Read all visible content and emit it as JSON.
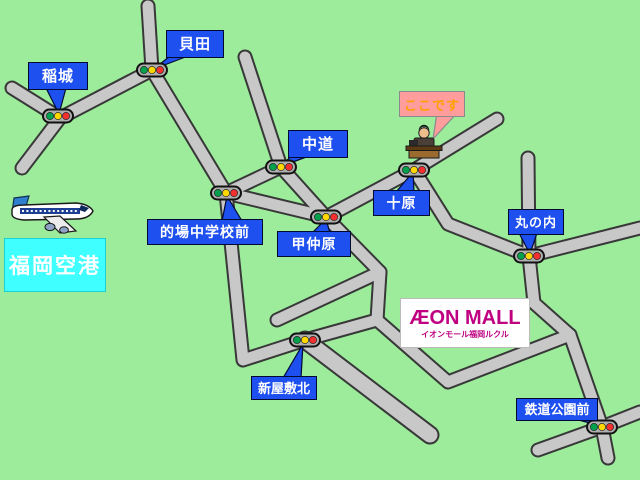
{
  "map": {
    "background_color": "#9CEC9C",
    "road_fill_color": "#C8C8C8",
    "road_outline_color": "#383838",
    "callout_bg_color": "#1E50F0",
    "stops": [
      {
        "label": "稲城"
      },
      {
        "label": "貝田"
      },
      {
        "label": "中道"
      },
      {
        "label": "的場中学校前"
      },
      {
        "label": "甲仲原"
      },
      {
        "label": "十原"
      },
      {
        "label": "丸の内"
      },
      {
        "label": "新屋敷北"
      },
      {
        "label": "鉄道公園前"
      }
    ],
    "here_callout": {
      "label": "ここです",
      "bg_color": "#FF9C9C",
      "text_color": "#FFA000"
    },
    "airport": {
      "label": "福岡空港",
      "bg_color": "#40FFFF",
      "text_color": "#FFFFFF"
    },
    "mall": {
      "name": "ÆON MALL",
      "subtitle": "イオンモール福岡ルクル",
      "brand_color": "#BE0081"
    },
    "traffic_light_colors": {
      "green": "#00A04C",
      "yellow": "#FFD800",
      "red": "#F23030"
    }
  }
}
